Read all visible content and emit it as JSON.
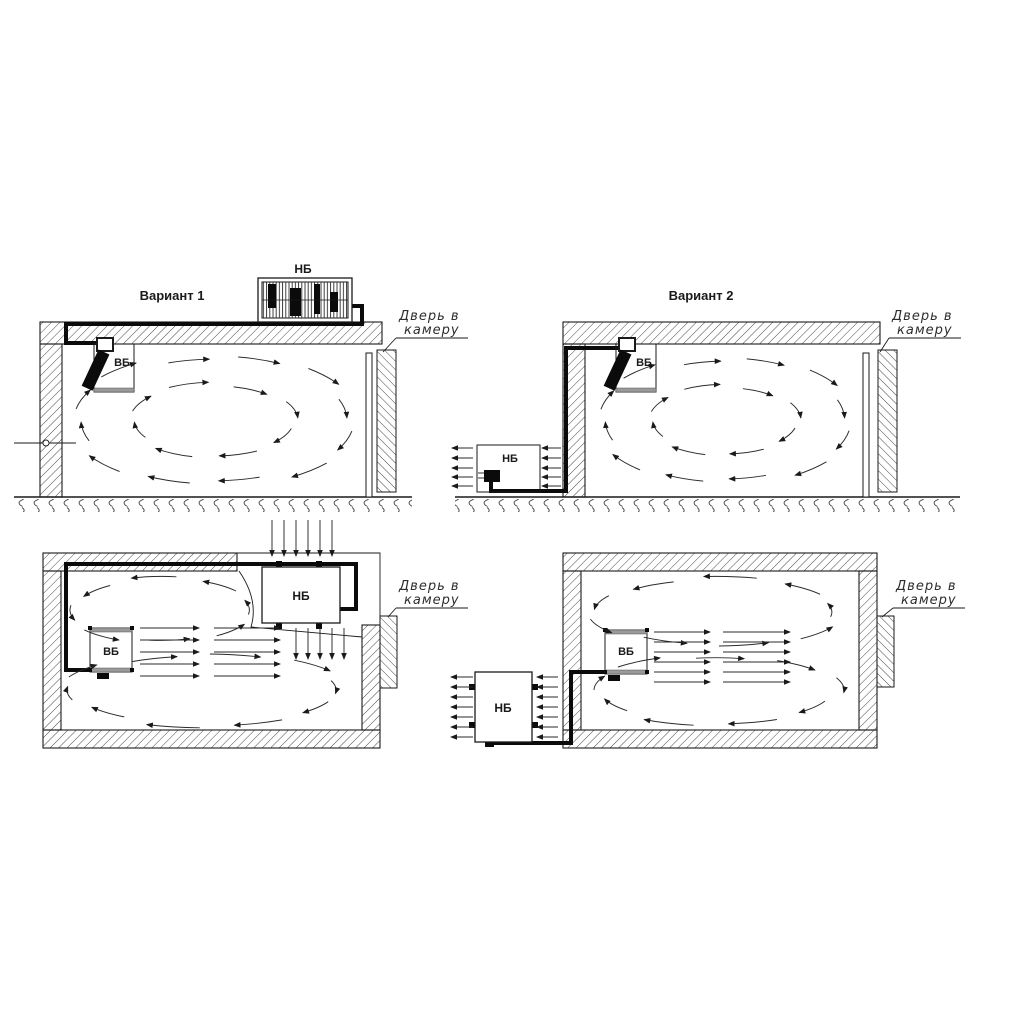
{
  "colors": {
    "bg": "#ffffff",
    "ink": "#1a1a1a",
    "flow": "#2a2a2a",
    "pipe": "#0b0b0b",
    "hatch": "#4a4a4a",
    "gray": "#9a9a9a"
  },
  "diagram": {
    "variant1": {
      "title": "Вариант 1",
      "outdoor_unit": "НБ",
      "indoor_unit": "ВБ",
      "door_label_line1": "Дверь в",
      "door_label_line2": "камеру"
    },
    "variant2": {
      "title": "Вариант 2",
      "outdoor_unit": "НБ",
      "indoor_unit": "ВБ",
      "door_label_line1": "Дверь в",
      "door_label_line2": "камеру"
    },
    "plan1": {
      "outdoor_unit": "НБ",
      "indoor_unit": "ВБ",
      "door_label_line1": "Дверь в",
      "door_label_line2": "камеру"
    },
    "plan2": {
      "outdoor_unit": "НБ",
      "indoor_unit": "ВБ",
      "door_label_line1": "Дверь в",
      "door_label_line2": "камеру"
    }
  }
}
